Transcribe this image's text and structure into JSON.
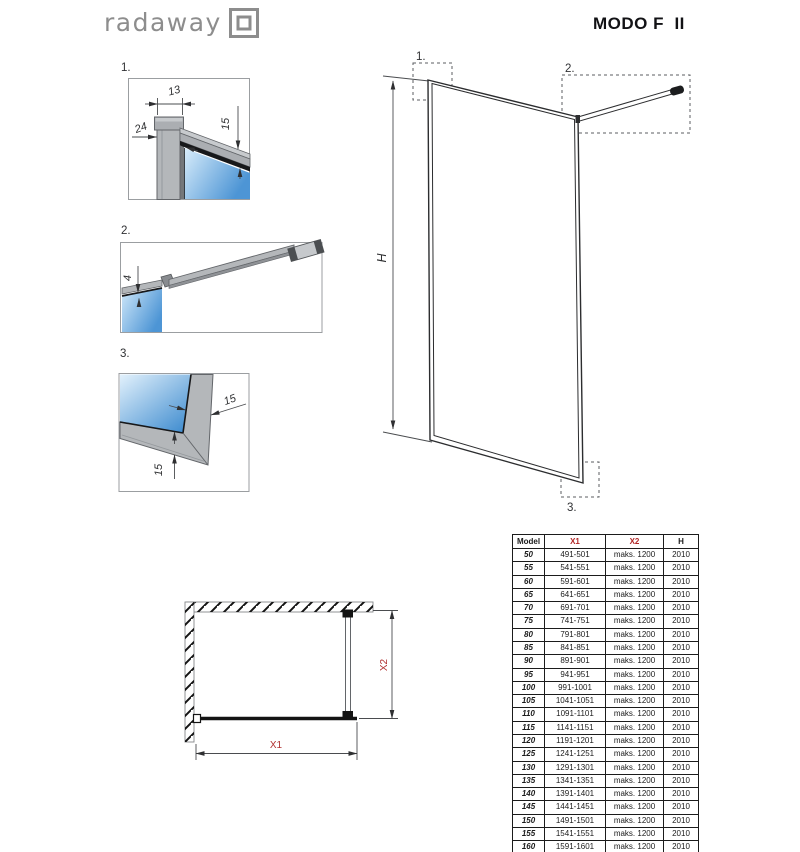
{
  "header": {
    "logo_text": "radaway",
    "title": "MODO F  II"
  },
  "detail1": {
    "label": "1.",
    "dim_width": "13",
    "dim_depth": "24",
    "dim_inset": "15"
  },
  "detail2": {
    "label": "2.",
    "dim_gap": "4"
  },
  "detail3": {
    "label": "3.",
    "dim_frame": "15",
    "dim_bottom": "15"
  },
  "main_view": {
    "label_1": "1.",
    "label_2": "2.",
    "label_3": "3.",
    "height_label": "H"
  },
  "plan_view": {
    "width_label": "X1",
    "depth_label": "X2"
  },
  "colors": {
    "accent_red": "#b22727",
    "glass_blue": "#4d95d5",
    "logo_gray": "#8d8d8d"
  },
  "table": {
    "headers": [
      "Model",
      "X1",
      "X2",
      "H"
    ],
    "rows": [
      [
        "50",
        "491-501",
        "maks. 1200",
        "2010"
      ],
      [
        "55",
        "541-551",
        "maks. 1200",
        "2010"
      ],
      [
        "60",
        "591-601",
        "maks. 1200",
        "2010"
      ],
      [
        "65",
        "641-651",
        "maks. 1200",
        "2010"
      ],
      [
        "70",
        "691-701",
        "maks. 1200",
        "2010"
      ],
      [
        "75",
        "741-751",
        "maks. 1200",
        "2010"
      ],
      [
        "80",
        "791-801",
        "maks. 1200",
        "2010"
      ],
      [
        "85",
        "841-851",
        "maks. 1200",
        "2010"
      ],
      [
        "90",
        "891-901",
        "maks. 1200",
        "2010"
      ],
      [
        "95",
        "941-951",
        "maks. 1200",
        "2010"
      ],
      [
        "100",
        "991-1001",
        "maks. 1200",
        "2010"
      ],
      [
        "105",
        "1041-1051",
        "maks. 1200",
        "2010"
      ],
      [
        "110",
        "1091-1101",
        "maks. 1200",
        "2010"
      ],
      [
        "115",
        "1141-1151",
        "maks. 1200",
        "2010"
      ],
      [
        "120",
        "1191-1201",
        "maks. 1200",
        "2010"
      ],
      [
        "125",
        "1241-1251",
        "maks. 1200",
        "2010"
      ],
      [
        "130",
        "1291-1301",
        "maks. 1200",
        "2010"
      ],
      [
        "135",
        "1341-1351",
        "maks. 1200",
        "2010"
      ],
      [
        "140",
        "1391-1401",
        "maks. 1200",
        "2010"
      ],
      [
        "145",
        "1441-1451",
        "maks. 1200",
        "2010"
      ],
      [
        "150",
        "1491-1501",
        "maks. 1200",
        "2010"
      ],
      [
        "155",
        "1541-1551",
        "maks. 1200",
        "2010"
      ],
      [
        "160",
        "1591-1601",
        "maks. 1200",
        "2010"
      ]
    ]
  }
}
